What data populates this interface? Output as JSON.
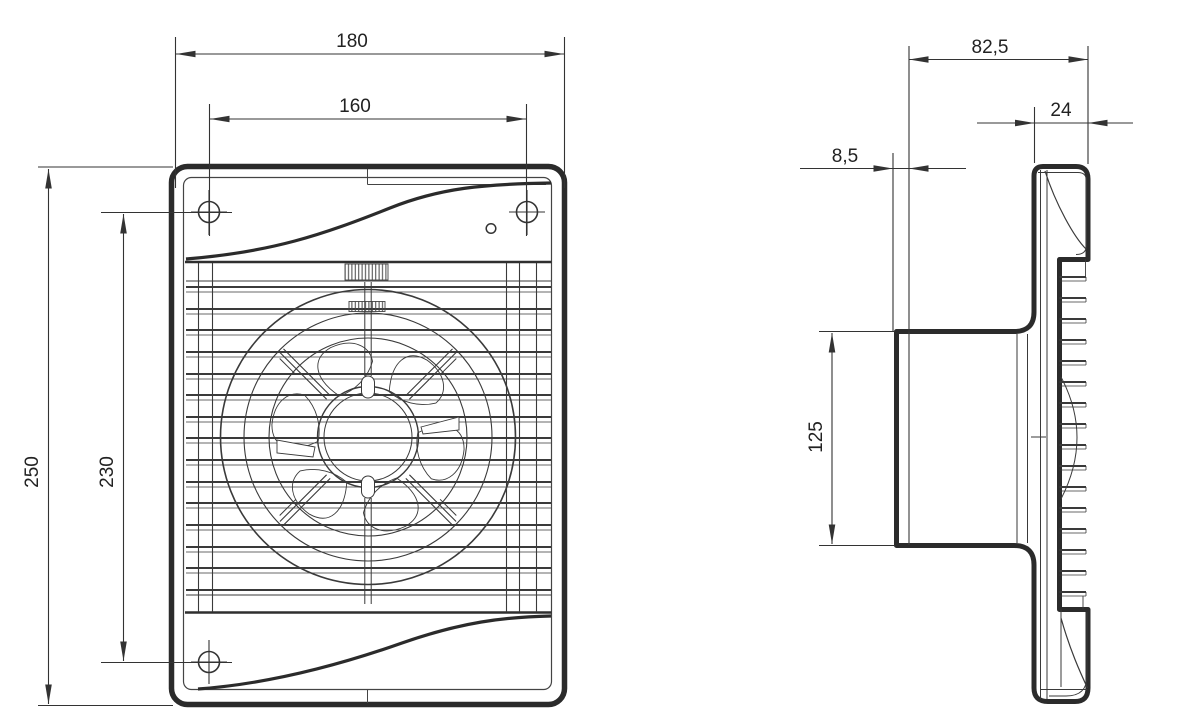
{
  "colors": {
    "line": "#333333",
    "outline": "#2b2b2b",
    "background": "#ffffff"
  },
  "front_view": {
    "dims": {
      "overall_width": "180",
      "hole_spacing_horizontal": "160",
      "overall_height": "250",
      "hole_spacing_vertical": "230"
    }
  },
  "side_view": {
    "dims": {
      "body_depth": "82,5",
      "front_panel_depth": "24",
      "flange_offset": "8,5",
      "duct_diameter": "125"
    }
  }
}
